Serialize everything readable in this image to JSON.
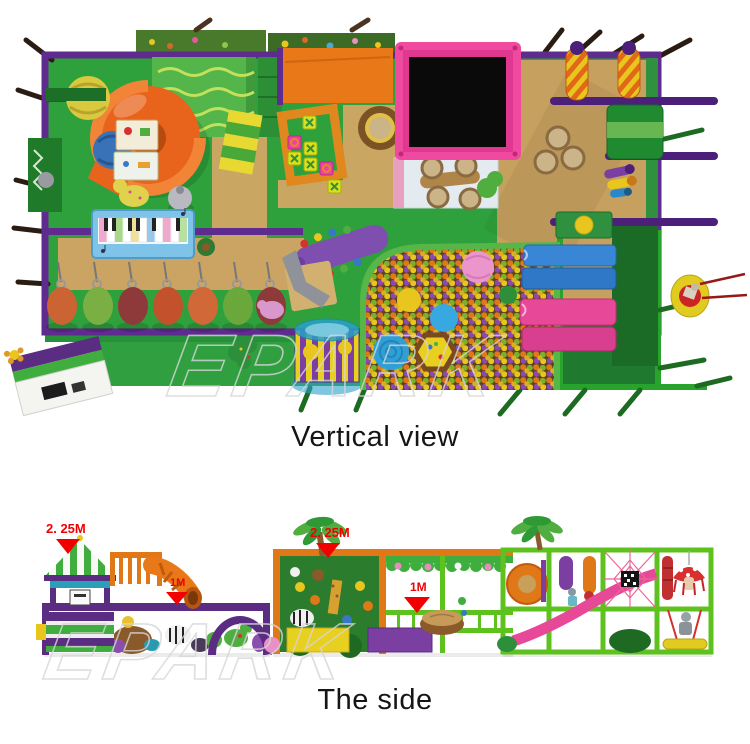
{
  "figure": {
    "brand_watermark": "EPARK",
    "views": [
      {
        "caption": "Vertical view"
      },
      {
        "caption": "The side"
      }
    ],
    "dimensions": [
      {
        "label": "2. 25M"
      },
      {
        "label": "2. 25M"
      },
      {
        "label": "1M"
      },
      {
        "label": "1M"
      }
    ],
    "colors": {
      "frame_purple": "#5f2b8e",
      "floor_green": "#2fa13c",
      "floor_tan": "#c6a05f",
      "frame_lime": "#5ec21e",
      "frame_orange": "#e07818",
      "trampoline_pink": "#f049a0",
      "label_red": "#f20000",
      "caption_black": "#151515"
    }
  }
}
